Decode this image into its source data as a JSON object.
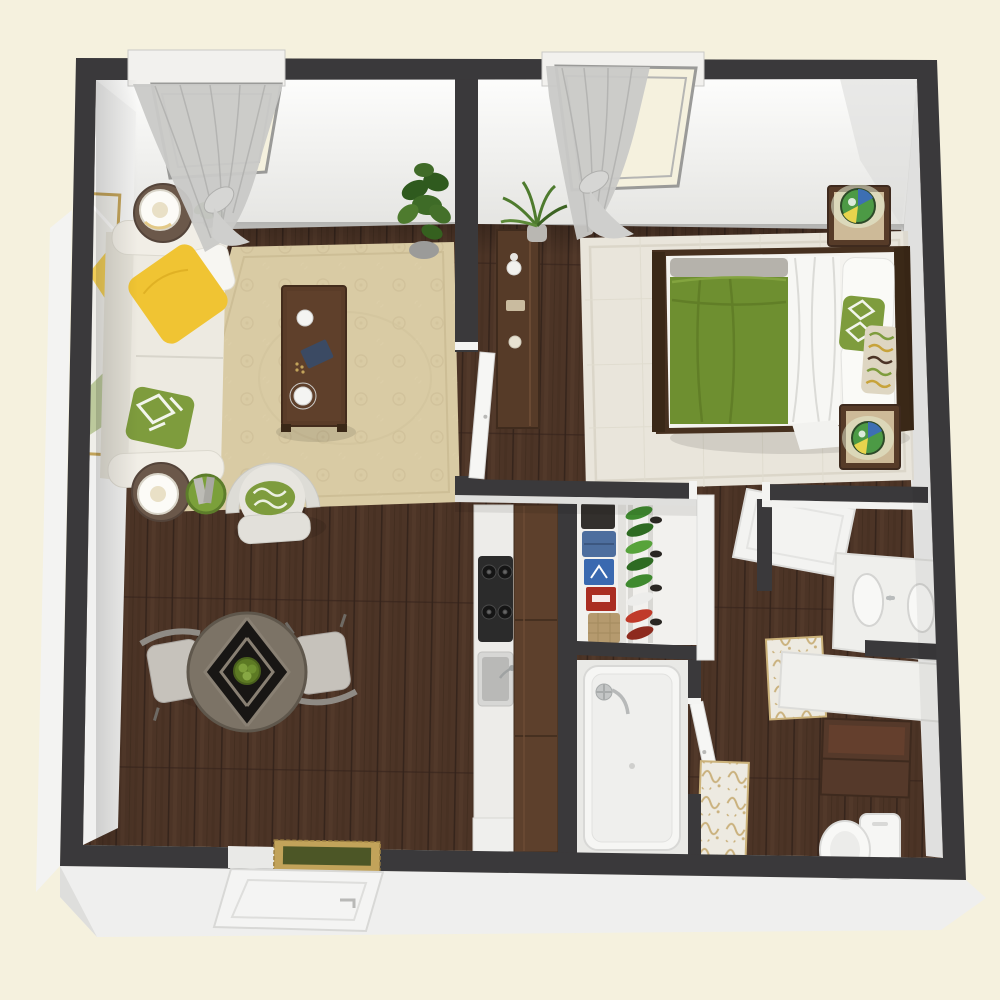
{
  "image_type": "3d-rendered-floor-plan",
  "view": "isometric-top-down",
  "colors": {
    "background": "#F5F1DE",
    "wall": "#3A393B",
    "wall_face": "#F4F3F1",
    "exterior_base": "#EFEFEE",
    "wood_floor": "#4C3426",
    "wood_streak": "#5D4130",
    "wood_gap": "#33221A",
    "area_rug": "#D9CBA4",
    "area_rug_pattern": "#C9B992",
    "bedroom_rug": "#E9E5DB",
    "sofa": "#EDEAE1",
    "accent_yellow": "#F0C433",
    "pillow_green": "#7E9C3D",
    "duvet_green": "#6E8F30",
    "bed_frame": "#46301F",
    "dark_wood_furniture": "#563B28",
    "cabinet_wood": "#5D402C",
    "coffee_table": "#5A3C28",
    "dining_table": "#7C7366",
    "chair_gray": "#C6C2BB",
    "counter_white": "#EDECE9",
    "fixture_white": "#F6F6F4",
    "chrome": "#B9BCBC",
    "gold_trim": "#C2A35A",
    "doormat_green": "#4C5626",
    "curtain": "#C9C9C7",
    "plant_green": "#4E7B2E",
    "denim_blue": "#4D6E9E",
    "box_blue": "#3A69B0",
    "box_red": "#AA2D22",
    "burlap": "#B59A6E",
    "shoe_green": "#3F8A2F",
    "shoe_red": "#C03A2A",
    "damask_gold": "#C6AB72",
    "tiffany_green": "#4C9A45",
    "tiffany_blue": "#3D6FB3",
    "tiffany_yellow": "#E8D44D"
  },
  "scene": {
    "rooms": [
      {
        "name": "living-room",
        "furniture": [
          "sofa",
          "yellow-pillow",
          "white-pillow",
          "green-lattice-pillow",
          "leaning-mirror",
          "side-table-lamp-top",
          "side-table-lamp-bottom",
          "coffee-table",
          "armchair",
          "magazine-basket",
          "area-rug",
          "fiddle-leaf-plant",
          "small-plant",
          "window-sheer-curtain"
        ]
      },
      {
        "name": "bedroom",
        "furniture": [
          "bed",
          "green-duvet",
          "white-pillows",
          "accent-pillows",
          "headboard",
          "nightstand-top",
          "nightstand-bottom",
          "tiffany-lamps",
          "console-table",
          "palm-plant",
          "bedroom-rug",
          "window-sheer-curtain"
        ]
      },
      {
        "name": "dining-area",
        "furniture": [
          "round-table",
          "fruit-bowl",
          "chair-left",
          "chair-right"
        ]
      },
      {
        "name": "kitchen",
        "furniture": [
          "counter",
          "cooktop",
          "sink",
          "cabinet-run",
          "appliance"
        ]
      },
      {
        "name": "closet",
        "furniture": [
          "folded-clothes",
          "denim-stack",
          "storage-boxes",
          "shoe-rack"
        ]
      },
      {
        "name": "bathroom",
        "furniture": [
          "bathtub-shower",
          "faucet",
          "door"
        ]
      },
      {
        "name": "vanity-bathroom",
        "furniture": [
          "double-sink-vanity",
          "counter",
          "wood-cabinet",
          "toilet",
          "damask-rugs",
          "open-door"
        ]
      },
      {
        "name": "entry",
        "furniture": [
          "front-door",
          "doormat"
        ]
      }
    ]
  }
}
